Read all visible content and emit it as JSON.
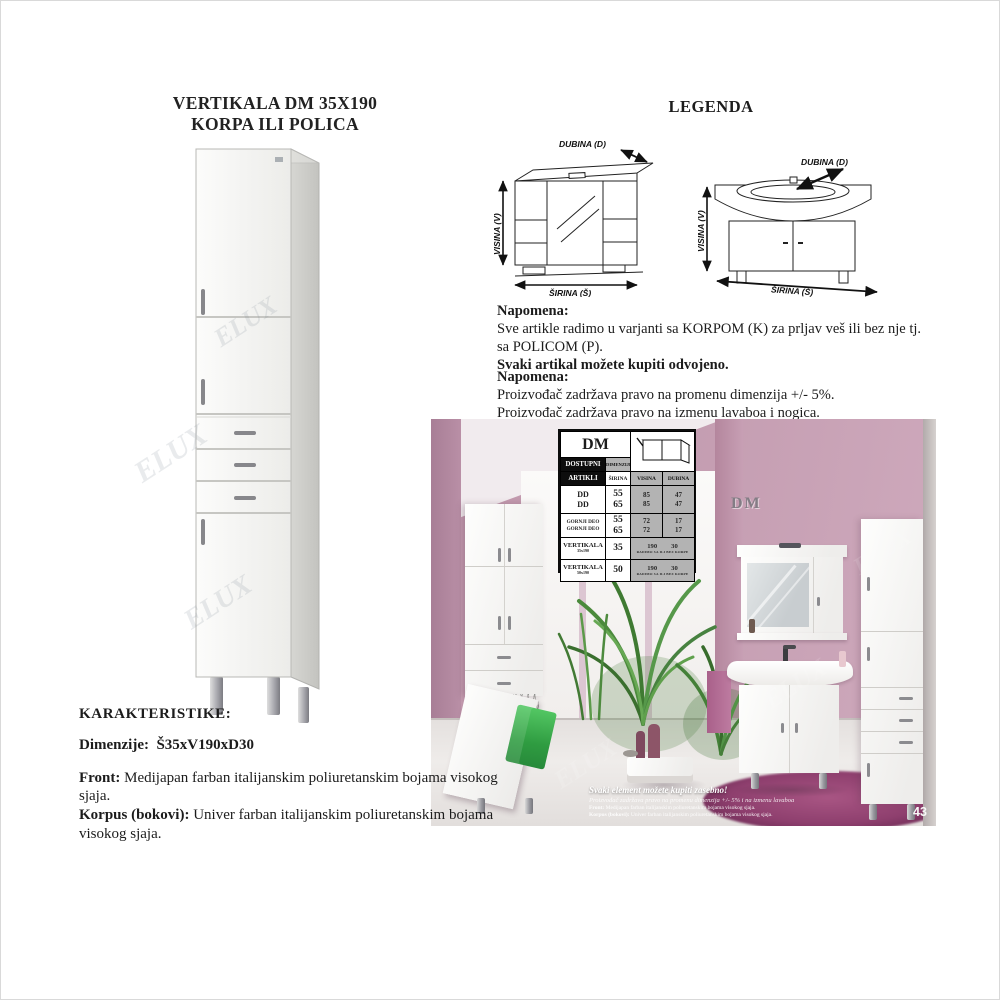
{
  "title": {
    "line1": "VERTIKALA DM 35X190",
    "line2": "KORPA ILI POLICA"
  },
  "legend": {
    "heading": "LEGENDA",
    "mirror_diagram": {
      "dubina": "DUBINA (D)",
      "visina": "VISINA (V)",
      "sirina": "ŠIRINA (Š)"
    },
    "vanity_diagram": {
      "dubina": "DUBINA (D)",
      "visina": "VISINA (V)",
      "sirina": "ŠIRINA (Š)"
    }
  },
  "note1": {
    "heading": "Napomena:",
    "line1": "Sve artikle radimo u varjanti sa KORPOM (K) za prljav veš ili bez nje tj.",
    "line2": "sa POLICOM (P).",
    "line3": "Svaki artikal možete kupiti odvojeno."
  },
  "note2": {
    "heading": "Napomena:",
    "line1": "Proizvođač zadržava pravo na promenu dimenzija +/- 5%.",
    "line2": "Proizvođač zadržava pravo na izmenu lavaboa i nogica."
  },
  "characteristics": {
    "heading": "KARAKTERISTIKE:",
    "dimensions_label": "Dimenzije:",
    "dimensions_value": "Š35xV190xD30",
    "front_label": "Front:",
    "front_text": " Medijapan farban italijanskim poliuretanskim bojama visokog sjaja.",
    "korpus_label": "Korpus (bokovi):",
    "korpus_text": " Univer farban italijanskim poliuretanskim bojama visokog sjaja."
  },
  "dm_table": {
    "title": "DM",
    "available_label_1": "DOSTUPNI",
    "available_label_2": "ARTIKLI",
    "dimensions_label": "DIMENZIJE",
    "col_sirina": "ŠIRINA",
    "col_visina": "VISINA",
    "col_dubina": "DUBINA",
    "rows": [
      {
        "name_a": "DD",
        "name_b": "DD",
        "sirina_a": "55",
        "sirina_b": "65",
        "visina_a": "85",
        "visina_b": "85",
        "dubina_a": "47",
        "dubina_b": "47"
      },
      {
        "name_a": "GORNJI DEO",
        "name_b": "GORNJI DEO",
        "sirina_a": "55",
        "sirina_b": "65",
        "visina_a": "72",
        "visina_b": "72",
        "dubina_a": "17",
        "dubina_b": "17"
      }
    ],
    "vert_rows": [
      {
        "name": "VERTIKALA",
        "sub": "35x190",
        "sirina": "35",
        "visina": "190",
        "dubina": "30",
        "footnote": "RADIMO SA ILI BEZ KORPE"
      },
      {
        "name": "VERTIKALA",
        "sub": "50x190",
        "sirina": "50",
        "visina": "190",
        "dubina": "30",
        "footnote": "RADIMO SA ILI BEZ KORPE"
      }
    ]
  },
  "photo": {
    "wall_logo": "DM",
    "caption_title": "Svaki element možete kupiti zasebno!",
    "caption_sub": "Proizvođač zadržava pravo na promenu dimenzija +/- 5% i na izmenu lavaboa",
    "caption_front_label": "Front:",
    "caption_front_text": " Medijapan farban italijanskim poliuretanskim bojama visokog sjaja.",
    "caption_korpus_label": "Korpus (bokovi):",
    "caption_korpus_text": " Univer farban italijanskim poliuretanskim bojama visokog sjaja.",
    "page_number": "43"
  },
  "watermark": "ELUX"
}
